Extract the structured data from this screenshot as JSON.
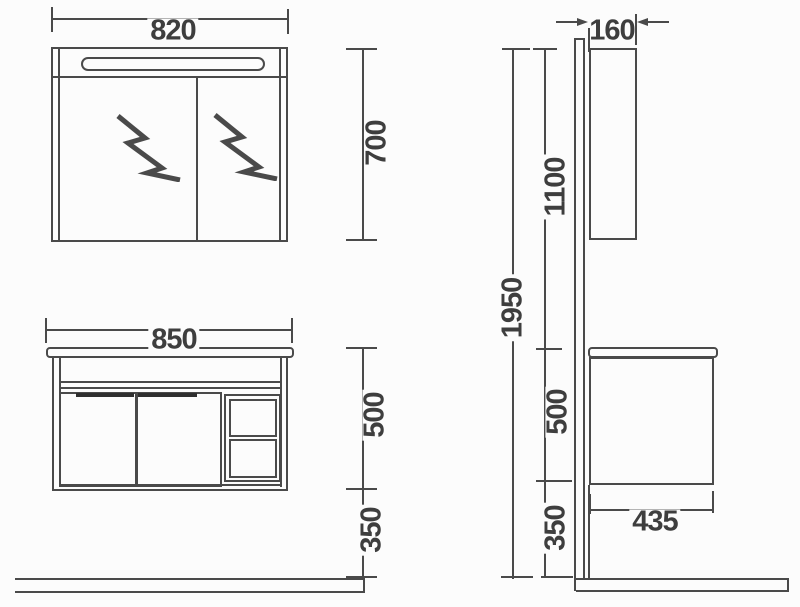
{
  "colors": {
    "line": "#4a4a4a",
    "text": "#3e3e3e",
    "background": "#fcfcfc",
    "handle": "#2f2f2f"
  },
  "dimensions": {
    "front_mirror_cabinet": {
      "width": "820",
      "height": "700"
    },
    "front_vanity": {
      "width": "850",
      "height": "500",
      "floor_clearance": "350"
    },
    "side_view": {
      "cabinet_depth": "160",
      "mirror_top_to_counter": "1100",
      "total_height": "1950",
      "vanity_height": "500",
      "floor_clearance": "350",
      "vanity_depth": "435"
    }
  },
  "icons": {
    "mirror_symbol": "lightning-zigzag-icon"
  }
}
